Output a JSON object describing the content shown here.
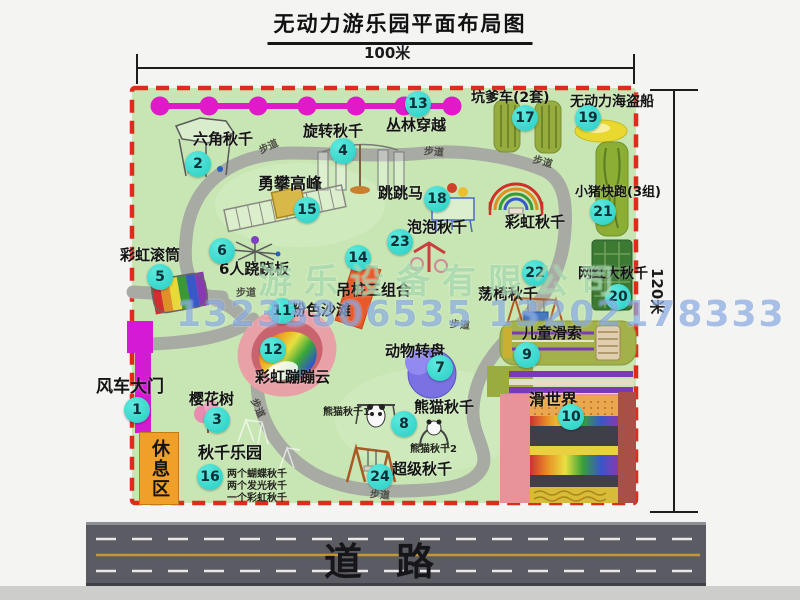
{
  "title": "无动力游乐园平面布局图",
  "dimensions": {
    "width_label": "100米",
    "height_label": "120米"
  },
  "road": {
    "label": "道路"
  },
  "rest_area": {
    "label": "休息区"
  },
  "walkway": {
    "label": "步道",
    "positions": [
      {
        "x": 258,
        "y": 138,
        "r": -25
      },
      {
        "x": 424,
        "y": 143,
        "r": 5
      },
      {
        "x": 533,
        "y": 153,
        "r": 15
      },
      {
        "x": 236,
        "y": 284,
        "r": 0
      },
      {
        "x": 450,
        "y": 316,
        "r": 5
      },
      {
        "x": 249,
        "y": 400,
        "r": 65
      },
      {
        "x": 370,
        "y": 486,
        "r": 5
      }
    ]
  },
  "watermark": {
    "line1": "游乐设备有限公司",
    "line2": "13233806535 13202178333"
  },
  "items": [
    {
      "num": "1",
      "name": "windmill-gate",
      "label": "风车大门",
      "bx": 137,
      "by": 410,
      "lx": 96,
      "ly": 379,
      "fs": 17
    },
    {
      "num": "2",
      "name": "hexagon-swing",
      "label": "六角秋千",
      "bx": 198,
      "by": 164,
      "lx": 193,
      "ly": 132,
      "fs": 15
    },
    {
      "num": "3",
      "name": "cherry-blossom-tree",
      "label": "樱花树",
      "bx": 217,
      "by": 420,
      "lx": 189,
      "ly": 392,
      "fs": 15
    },
    {
      "num": "4",
      "name": "rotating-swing",
      "label": "旋转秋千",
      "bx": 343,
      "by": 151,
      "lx": 303,
      "ly": 124,
      "fs": 15
    },
    {
      "num": "5",
      "name": "rainbow-roller",
      "label": "彩虹滚筒",
      "bx": 160,
      "by": 277,
      "lx": 120,
      "ly": 248,
      "fs": 15
    },
    {
      "num": "6",
      "name": "six-person-seesaw",
      "label": "6人跷跷板",
      "bx": 222,
      "by": 251,
      "lx": 219,
      "ly": 262,
      "fs": 15
    },
    {
      "num": "7",
      "name": "animal-carousel",
      "label": "动物转盘",
      "bx": 440,
      "by": 368,
      "lx": 385,
      "ly": 344,
      "fs": 15
    },
    {
      "num": "8",
      "name": "panda-swing",
      "label": "熊猫秋千",
      "bx": 404,
      "by": 424,
      "lx": 414,
      "ly": 400,
      "fs": 15
    },
    {
      "num": "9",
      "name": "kids-zipline",
      "label": "儿童滑索",
      "bx": 527,
      "by": 355,
      "lx": 522,
      "ly": 326,
      "fs": 15
    },
    {
      "num": "10",
      "name": "slide-world",
      "label": "滑世界",
      "bx": 571,
      "by": 417,
      "lx": 529,
      "ly": 392,
      "fs": 16
    },
    {
      "num": "11",
      "name": "pink-beach",
      "label": "粉色沙滩",
      "bx": 282,
      "by": 311,
      "lx": 291,
      "ly": 303,
      "fs": 15
    },
    {
      "num": "12",
      "name": "rainbow-bouncing-cloud",
      "label": "彩虹蹦蹦云",
      "bx": 273,
      "by": 350,
      "lx": 255,
      "ly": 370,
      "fs": 15
    },
    {
      "num": "13",
      "name": "jungle-crossing",
      "label": "丛林穿越",
      "bx": 418,
      "by": 104,
      "lx": 386,
      "ly": 118,
      "fs": 15
    },
    {
      "num": "14",
      "name": "hanging-post-combo",
      "label": "吊桩三组合",
      "bx": 358,
      "by": 258,
      "lx": 336,
      "ly": 283,
      "fs": 15
    },
    {
      "num": "15",
      "name": "peak-climbing",
      "label": "勇攀高峰",
      "bx": 307,
      "by": 210,
      "lx": 258,
      "ly": 176,
      "fs": 16
    },
    {
      "num": "16",
      "name": "swing-park",
      "label": "秋千乐园",
      "bx": 210,
      "by": 477,
      "lx": 198,
      "ly": 445,
      "fs": 16
    },
    {
      "num": "17",
      "name": "pit-cart",
      "label": "坑爹车(2套)",
      "bx": 525,
      "by": 118,
      "lx": 471,
      "ly": 91,
      "fs": 14
    },
    {
      "num": "18",
      "name": "jumping-horse",
      "label": "跳跳马",
      "bx": 437,
      "by": 199,
      "lx": 378,
      "ly": 186,
      "fs": 15
    },
    {
      "num": "19",
      "name": "pirate-ship",
      "label": "无动力海盗船",
      "bx": 588,
      "by": 118,
      "lx": 570,
      "ly": 95,
      "fs": 14
    },
    {
      "num": "20",
      "name": "influencer-big-swing",
      "label": "网红大秋千",
      "bx": 618,
      "by": 297,
      "lx": 578,
      "ly": 267,
      "fs": 14
    },
    {
      "num": "21",
      "name": "piggy-run",
      "label": "小猪快跑(3组)",
      "bx": 603,
      "by": 212,
      "lx": 575,
      "ly": 186,
      "fs": 13
    },
    {
      "num": "22",
      "name": "rocking-chair-swing",
      "label": "荡椅秋千",
      "bx": 535,
      "by": 273,
      "lx": 478,
      "ly": 287,
      "fs": 15
    },
    {
      "num": "23",
      "name": "bubble-swing",
      "label": "泡泡秋千",
      "bx": 400,
      "by": 242,
      "lx": 407,
      "ly": 220,
      "fs": 15
    },
    {
      "num": "24",
      "name": "super-swing",
      "label": "超级秋千",
      "bx": 380,
      "by": 477,
      "lx": 392,
      "ly": 462,
      "fs": 15
    },
    {
      "num": "",
      "name": "rainbow-swing",
      "label": "彩虹秋千",
      "bx": 0,
      "by": 0,
      "lx": 505,
      "ly": 215,
      "fs": 15
    }
  ],
  "small_notes": [
    {
      "name": "panda-swing-1-note",
      "text": "熊猫秋千1",
      "x": 323,
      "y": 403
    },
    {
      "name": "panda-swing-2-note",
      "text": "熊猫秋千2",
      "x": 410,
      "y": 440
    },
    {
      "name": "swing-park-note-1",
      "text": "两个蝴蝶秋千",
      "x": 227,
      "y": 465
    },
    {
      "name": "swing-park-note-2",
      "text": "两个发光秋千",
      "x": 227,
      "y": 477
    },
    {
      "name": "swing-park-note-3",
      "text": "一个彩虹秋千",
      "x": 227,
      "y": 489
    }
  ],
  "colors": {
    "map_green": "#c8e6b4",
    "border_red": "#df2a1c",
    "badge_cyan": "#2fd6ca",
    "chain_magenta": "#e01ac8",
    "road_gray": "#5a5b63",
    "rest_orange": "#f0a028"
  }
}
